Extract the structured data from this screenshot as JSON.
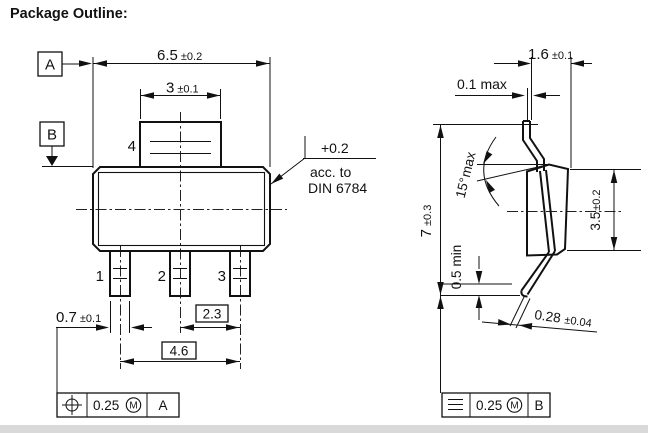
{
  "title": "Package Outline:",
  "front_view": {
    "datums": {
      "a": "A",
      "b": "B"
    },
    "pins": {
      "p1": "1",
      "p2": "2",
      "p3": "3",
      "p4": "4"
    },
    "dims": {
      "body_width": {
        "value": "6.5",
        "tol": "±0.2"
      },
      "tab_width": {
        "value": "3",
        "tol": "±0.1"
      },
      "lead_width": {
        "value": "0.7",
        "tol": "±0.1"
      },
      "lead_pitch": {
        "value": "2.3"
      },
      "lead_span": {
        "value": "4.6"
      }
    },
    "edge_note": {
      "tol": "+0.2",
      "line1": "acc. to",
      "line2": "DIN 6784"
    },
    "tolerance_frame": {
      "symbol_icon": "position-symbol",
      "value": "0.25",
      "modifier": "M",
      "datum": "A"
    }
  },
  "side_view": {
    "dims": {
      "tab_thickness": {
        "value": "1.6",
        "tol": "±0.1"
      },
      "tip_offset": {
        "value": "0.1",
        "qual": "max"
      },
      "height": {
        "value": "7",
        "tol": "±0.3"
      },
      "draft_angle": {
        "value": "15°",
        "qual": "max"
      },
      "standoff": {
        "value": "0.5",
        "qual": "min"
      },
      "body_thickness": {
        "value": "3.5",
        "tol": "±0.2"
      },
      "lead_thickness": {
        "value": "0.28",
        "tol": "±0.04"
      }
    },
    "tolerance_frame": {
      "symbol_icon": "symmetry-symbol",
      "value": "0.25",
      "modifier": "M",
      "datum": "B"
    }
  },
  "colors": {
    "ink": "#111111",
    "background": "#ffffff",
    "scan_edge": "#d9d9d9"
  }
}
